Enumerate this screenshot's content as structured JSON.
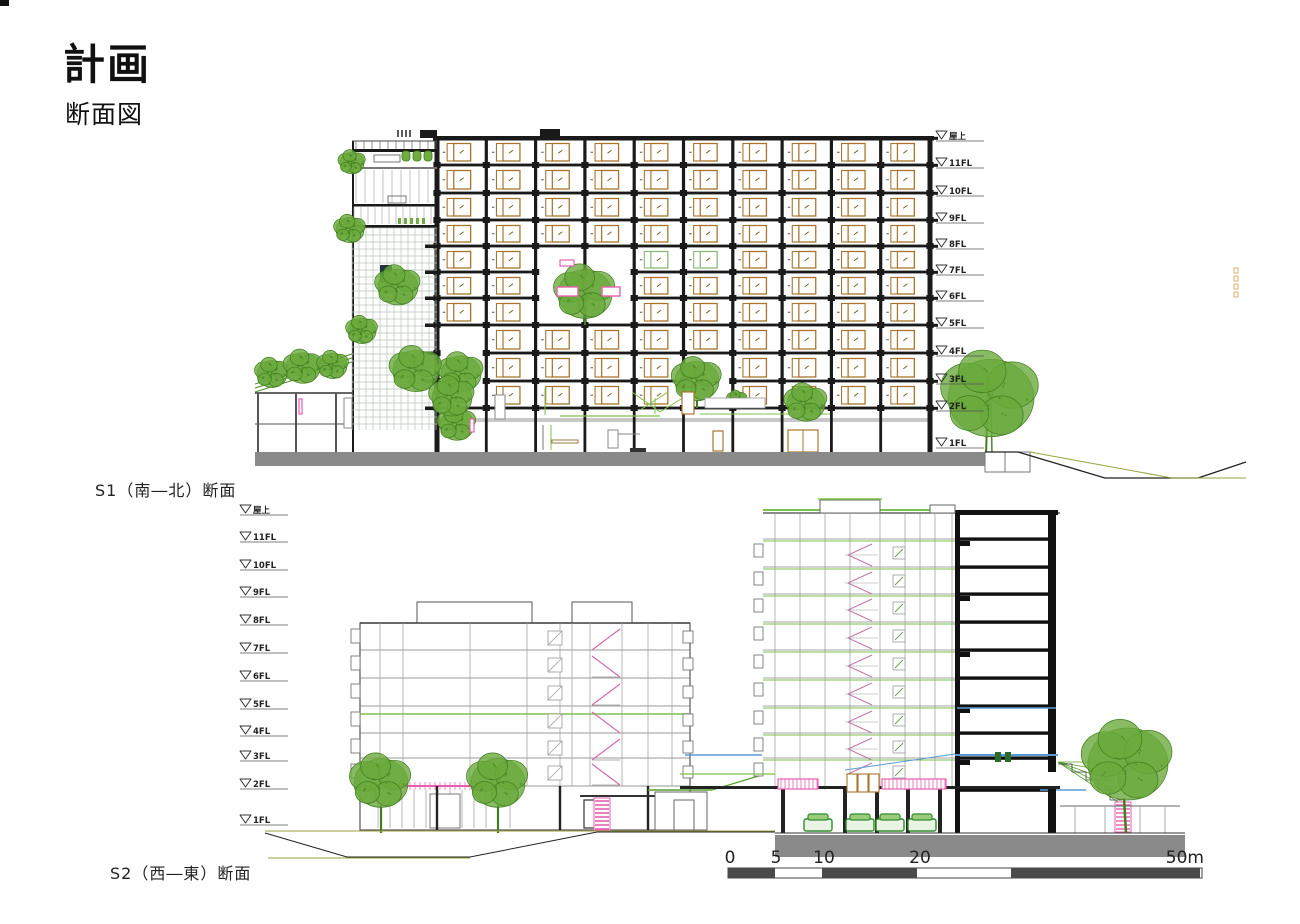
{
  "header": {
    "title": "計画",
    "subtitle": "断面図"
  },
  "s1": {
    "caption": "S1（南―北）断面",
    "floor_labels": [
      "屋上",
      "11FL",
      "10FL",
      "9FL",
      "8FL",
      "7FL",
      "6FL",
      "5FL",
      "4FL",
      "3FL",
      "2FL",
      "1FL"
    ]
  },
  "s2": {
    "caption": "S2（西―東）断面",
    "floor_labels": [
      "屋上",
      "11FL",
      "10FL",
      "9FL",
      "8FL",
      "7FL",
      "6FL",
      "5FL",
      "4FL",
      "3FL",
      "2FL",
      "1FL"
    ]
  },
  "scale_bar": {
    "labels": [
      "0",
      "5",
      "10",
      "20",
      "50m"
    ]
  },
  "colors": {
    "ink": "#1a1a1a",
    "thin_grey": "#8f8f8f",
    "tan": "#a9752c",
    "tree_green": "#6aaa3c",
    "tree_dark": "#3f7d1e",
    "light_green": "#7cc24a",
    "olive": "#9aa23f",
    "pink": "#e85fb0",
    "blue": "#5b9bd5",
    "ground_grey": "#8a8a8a",
    "scale_dark": "#4a4a4a",
    "lattice_grey": "#b9c4b9",
    "label_ink": "#222222"
  }
}
